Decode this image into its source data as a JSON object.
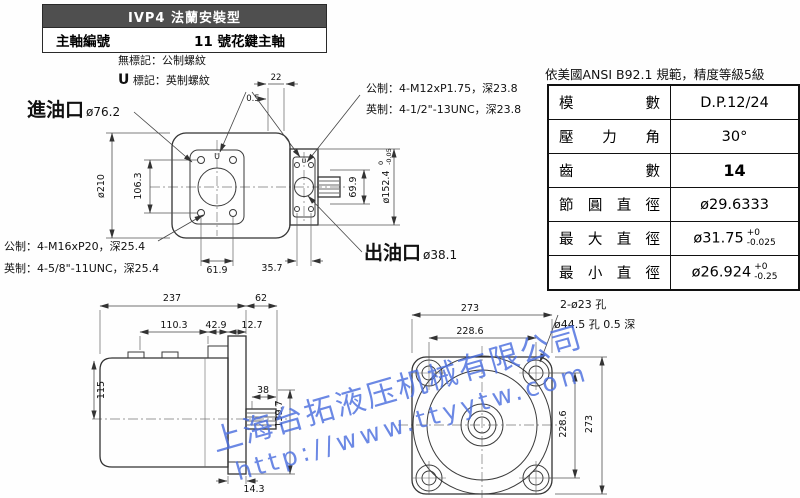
{
  "title_block": {
    "model_line": "IVP4 法蘭安裝型",
    "spindle_label": "主軸編號",
    "spindle_value": "11 號花鍵主軸"
  },
  "notes": {
    "no_mark": "無標記：公制螺紋",
    "u_mark_prefix": "U",
    "u_mark_rest": " 標記：英制螺紋",
    "u_symbol": "U",
    "inlet_label": "進油口",
    "inlet_dia": "ø76.2",
    "outlet_label": "出油口",
    "outlet_dia": "ø38.1",
    "top_metric": "公制：4-M12xP1.75，深23.8",
    "top_inch": "英制：4-1/2\"-13UNC，深23.8",
    "left_metric": "公制：4-M16xP20，深25.4",
    "left_inch": "英制：4-5/8\"-11UNC，深25.4",
    "front_holes": "2-ø23 孔",
    "front_recess": "ø44.5 孔 0.5 深"
  },
  "dims": {
    "top": {
      "outer_dia": "ø210",
      "face_v": "106.3",
      "face_h": "61.9",
      "rear_h": "35.7",
      "rear_v": "69.9",
      "pilot_dia": "ø152.4",
      "pilot_tol_top": "0",
      "pilot_tol_bot": "-0.05",
      "step": "0.5",
      "boss_w": "22"
    },
    "side": {
      "overall": "237",
      "rear_len": "62",
      "seg_a": "110.3",
      "seg_b": "42.9",
      "seg_c": "12.7",
      "height": "115",
      "spline_len": "38",
      "flange_h": "139.7",
      "foot": "14.3"
    },
    "front": {
      "flange_w": "273",
      "bolt_w": "228.6",
      "bolt_h": "228.6",
      "flange_h": "273"
    }
  },
  "spline_table": {
    "caption": "依美國ANSI B92.1 規範，精度等級5級",
    "rows": [
      {
        "label": "模數",
        "value": "D.P.12/24"
      },
      {
        "label": "壓力角",
        "value": "30°"
      },
      {
        "label": "齒數",
        "value": "14"
      },
      {
        "label": "節圓直徑",
        "value": "ø29.6333"
      },
      {
        "label": "最大直徑",
        "value": "ø31.75",
        "tol_plus": "+0",
        "tol_minus": "-0.025"
      },
      {
        "label": "最小直徑",
        "value": "ø26.924",
        "tol_plus": "+0",
        "tol_minus": "-0.25"
      }
    ]
  },
  "watermark": {
    "line1": "上海台拓液压机械有限公司",
    "line2": "http://www.ttyytw.com",
    "color": "#4a6ede"
  }
}
